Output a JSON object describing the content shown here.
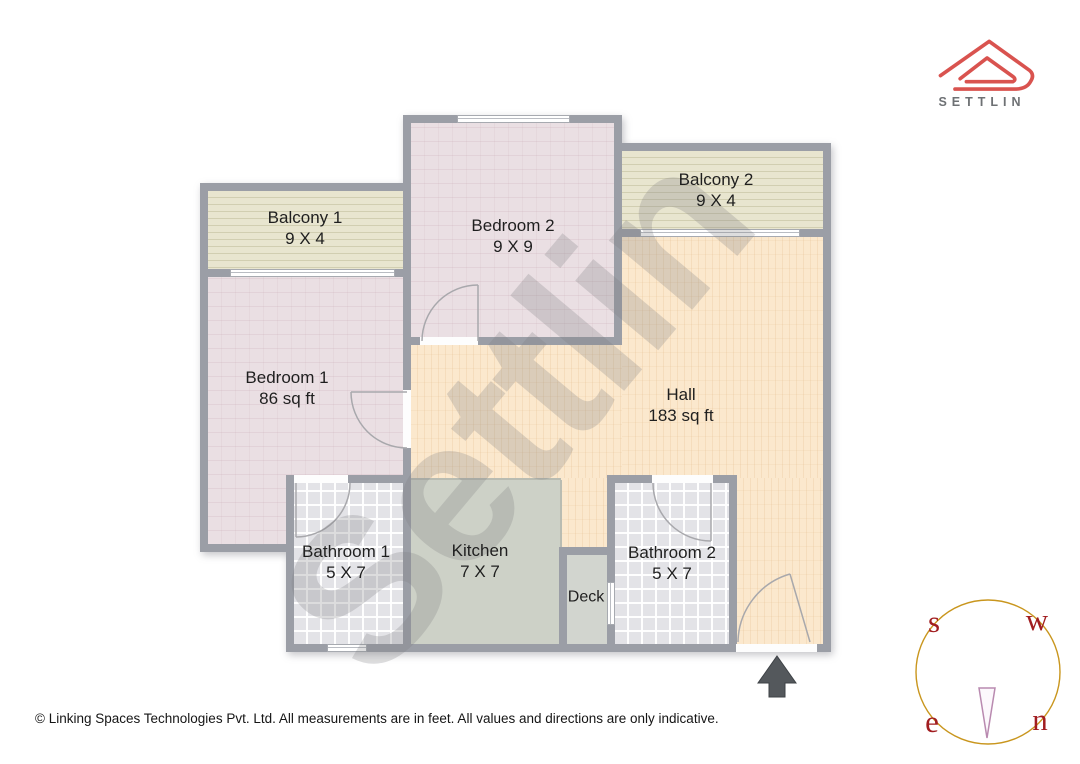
{
  "brand": {
    "logo_text": "SETTLIN",
    "watermark": "Settlin"
  },
  "rooms": {
    "balcony1": {
      "name": "Balcony 1",
      "dims": "9 X 4"
    },
    "bedroom2": {
      "name": "Bedroom 2",
      "dims": "9 X 9"
    },
    "balcony2": {
      "name": "Balcony 2",
      "dims": "9 X 4"
    },
    "bedroom1": {
      "name": "Bedroom 1",
      "dims": "86 sq ft"
    },
    "hall": {
      "name": "Hall",
      "dims": "183 sq ft"
    },
    "bathroom1": {
      "name": "Bathroom 1",
      "dims": "5 X 7"
    },
    "kitchen": {
      "name": "Kitchen",
      "dims": "7 X 7"
    },
    "deck": {
      "name": "Deck"
    },
    "bathroom2": {
      "name": "Bathroom 2",
      "dims": "5 X 7"
    }
  },
  "compass": {
    "south": "s",
    "west": "w",
    "east": "e",
    "north": "n"
  },
  "footer": {
    "copyright": "© Linking Spaces Technologies Pvt. Ltd. All measurements are in feet. All values and directions are only indicative."
  },
  "colors": {
    "logo_red": "#d9534f",
    "logo_text_gray": "#6e7174",
    "wall": "#9b9ea6",
    "bedroom_fill": "#eadfe3",
    "balcony_fill": "#e8e5cf",
    "hall_fill": "#fbe8cd",
    "kitchen_fill": "#cdd1c7",
    "bathroom_fill": "#e3e3e7",
    "deck_fill": "#d2d5cf",
    "compass_ring": "#c9961e",
    "compass_letters": "#a11d20",
    "needle": "#b98ab0",
    "entrance_arrow": "#54585c",
    "label_text": "#1f1f1f"
  }
}
